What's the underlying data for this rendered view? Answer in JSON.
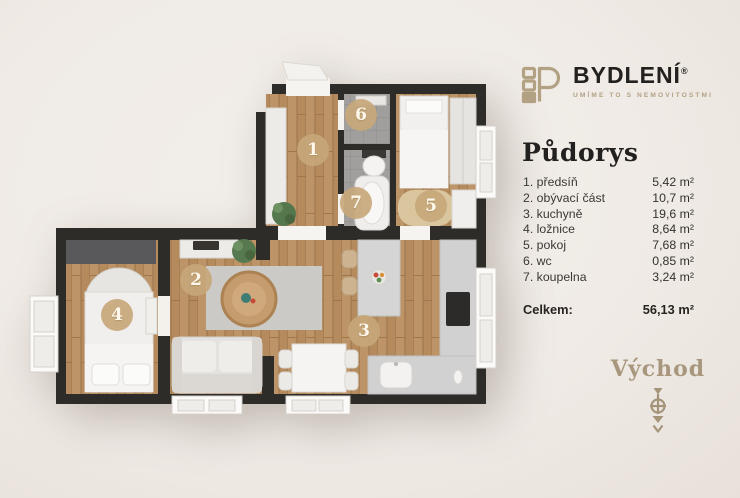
{
  "colors": {
    "background": "#f0ebe6",
    "brand_tan": "#b3a183",
    "wall": "#2e2c29",
    "wood_floor": "#b58b5e",
    "tile_floor": "#a2a19f",
    "badge": "#c7a77a",
    "heading_text": "#23211f"
  },
  "brand": {
    "name": "BYDLENÍ",
    "registered_mark": "®",
    "tagline": "UMÍME TO S NEMOVITOSTMI"
  },
  "panel": {
    "title": "Půdorys",
    "rooms": [
      {
        "label": "1. předsíň",
        "area": "5,42 m²"
      },
      {
        "label": "2. obývací část",
        "area": "10,7 m²"
      },
      {
        "label": "3. kuchyně",
        "area": "19,6 m²"
      },
      {
        "label": "4. ložnice",
        "area": "8,64 m²"
      },
      {
        "label": "5. pokoj",
        "area": "7,68 m²"
      },
      {
        "label": "6. wc",
        "area": "0,85 m²"
      },
      {
        "label": "7. koupelna",
        "area": "3,24 m²"
      }
    ],
    "total": {
      "label": "Celkem:",
      "value": "56,13 m²"
    },
    "orientation": {
      "label": "Východ"
    }
  },
  "floorplan": {
    "badges": [
      "1",
      "2",
      "3",
      "4",
      "5",
      "6",
      "7"
    ]
  }
}
